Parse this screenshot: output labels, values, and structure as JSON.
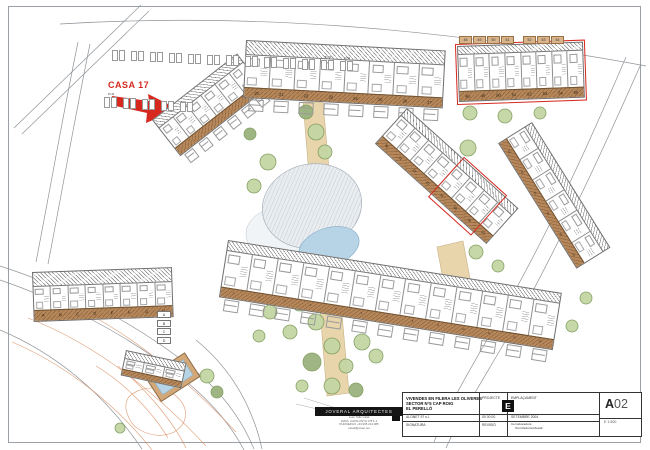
{
  "colors": {
    "red": "#d6281e",
    "terrace": "#b5875a",
    "walkway": "#e8d5ac",
    "walkway_edge": "#c9b286",
    "pool_blue": "#b7d3e6",
    "pool_edge": "#8fb3cc",
    "tree_fill": "#c4d6a4",
    "tree_fill_dark": "#9ab37e",
    "tree_stroke": "#7f9c5d",
    "contour": "#d98a5c",
    "line": "#8f9499",
    "hatch_gray": "#c3cad2"
  },
  "annotations": {
    "casa_label": "CASA 17"
  },
  "plan": {
    "row_labels": {
      "r1": [
        "",
        "",
        "",
        "",
        "",
        ""
      ],
      "r2": [
        "20",
        "21",
        "22",
        "23",
        "24",
        "25",
        "26",
        "27"
      ],
      "r3": [
        "48",
        "49",
        "50",
        "51",
        "52",
        "53",
        "54",
        "55"
      ],
      "r4": [
        "30",
        "31",
        "32",
        "33",
        "34",
        "35",
        "36",
        "37"
      ],
      "r5": [
        "42",
        "43",
        "44",
        "45",
        "46",
        "47"
      ],
      "r6": [
        "1",
        "2",
        "3",
        "4",
        "5",
        "6",
        "7",
        "8",
        "9",
        "10",
        "11",
        "12",
        "13"
      ],
      "r7": [
        "A",
        "B",
        "C",
        "D",
        "E",
        "F",
        "G",
        "H"
      ],
      "r8": [
        "",
        "",
        ""
      ]
    },
    "stall_labels_top_right": [
      "48",
      "49",
      "50",
      "51",
      "52",
      "53",
      "54"
    ],
    "stall_labels_left_upper": [
      "",
      "",
      "",
      "",
      "",
      "",
      "",
      "",
      "",
      "",
      "",
      "51 52",
      "53 54"
    ],
    "stall_labels_left_lower": [
      "35 36",
      "",
      "",
      "",
      ""
    ],
    "legend_boxes": [
      "A",
      "B",
      "C",
      "D"
    ]
  },
  "title_block": {
    "project_lines": [
      "VIVENDES EN FILERA LES OLIVERES",
      "SECTOR N°5 CAP ROIG",
      "EL PERELLÓ"
    ],
    "projecte_label": "PROJECTE",
    "emplacament_label": "EMPLAÇAMENT",
    "promoter": "ALONET 97 s.l.",
    "date_code": "00 00 00",
    "date": "SETEMBRE 2004",
    "signatura_label": "SIGNATURA",
    "revisio_label": "REVISIÓ",
    "collaborators_label": "Col·laboradors:",
    "collaborators_name": "Toni Redorta Mesalt",
    "sheet_letter": "E",
    "sheet_code_bold": "A",
    "sheet_code_num": "02",
    "scale": "E 1:500"
  },
  "logo": {
    "name": "JOVERAL ARQUITECTES",
    "lines": [
      "Joan Tallé Calaf",
      "AVDA. CATALUNYA 178 1-1",
      "PHONE/FAX +34 935 214 085",
      "estudi@coac.net"
    ]
  }
}
